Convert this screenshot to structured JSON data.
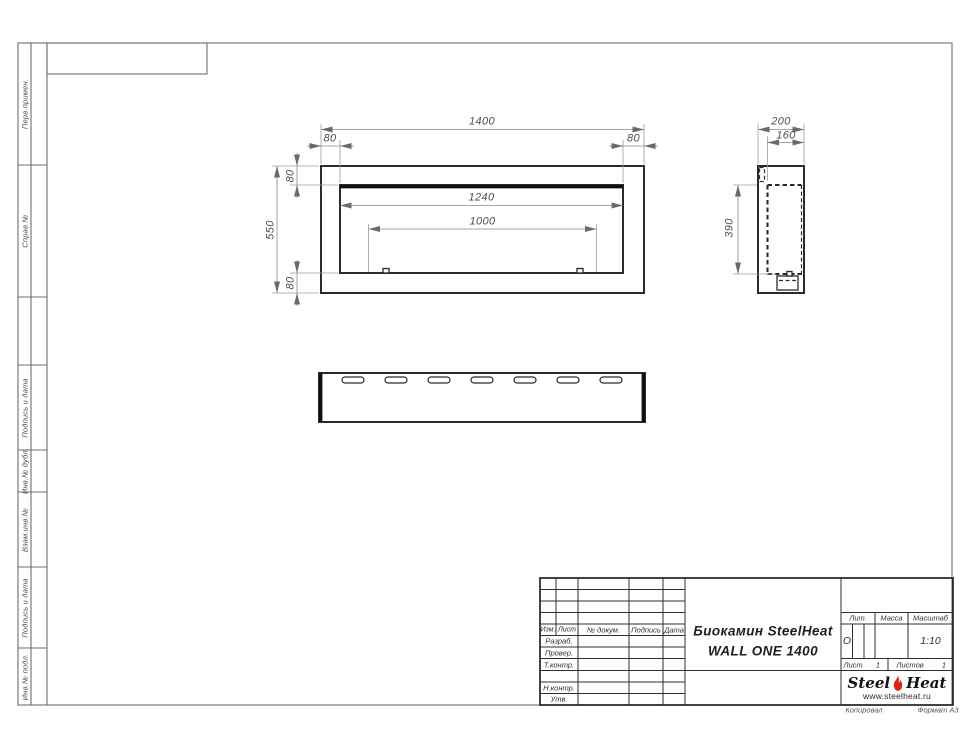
{
  "page": {
    "colors": {
      "flame_red": "#e32119",
      "line_dark": "#2b2b2b",
      "dim_gray": "#8a8a8a"
    }
  },
  "margin_labels": [
    "Перв.примен.",
    "Справ.№",
    "Подпись и дата",
    "Инв.№ дубл.",
    "Взам.инв.№",
    "Подпись и дата",
    "Инв.№ подл."
  ],
  "drawing": {
    "front_view": {
      "overall_width": "1400",
      "inset_left": "80",
      "inset_right": "80",
      "overall_height": "550",
      "inset_top": "80",
      "inset_bottom": "80",
      "opening_width": "1240",
      "burner_span": "1000"
    },
    "side_view": {
      "depth": "200",
      "inner_depth": "160",
      "inner_height": "390"
    }
  },
  "title_block": {
    "title_line1": "Биокамин SteelHeat",
    "title_line2": "WALL ONE 1400",
    "headers": {
      "izm": "Изм.",
      "list": "Лист",
      "doc_no": "№ докум.",
      "sign": "Подпись",
      "date": "Дата",
      "lit": "Лит.",
      "mass": "Масса",
      "scale": "Масштаб",
      "sheet": "Лист",
      "sheets": "Листов"
    },
    "row_labels": {
      "razrab": "Разраб.",
      "prover": "Провер.",
      "tkontr": "Т.контр.",
      "nkontr": "Н.контр.",
      "utv": "Утв."
    },
    "values": {
      "lit": "О",
      "scale": "1:10",
      "sheet_no": "1",
      "sheets_total": "1"
    },
    "logo": {
      "word1": "Steel",
      "word2": "Heat",
      "site": "www.steelheat.ru"
    },
    "footer": {
      "copied": "Копировал",
      "format": "Формат А3"
    }
  }
}
